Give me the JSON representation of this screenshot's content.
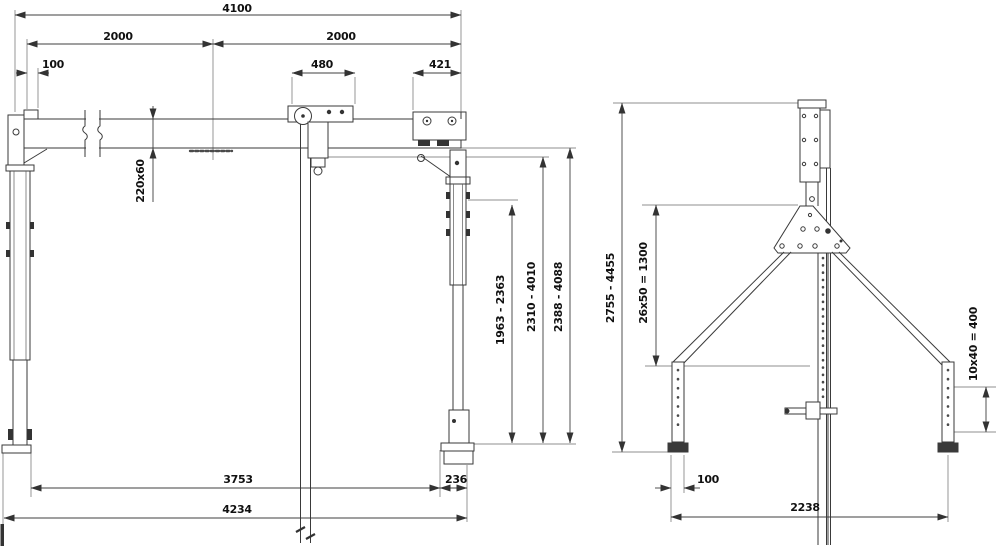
{
  "drawing": {
    "title": "gantry-crane-dimension-drawing",
    "views": {
      "front": {
        "name": "front-view",
        "dims": {
          "overall_rail_length": "4100",
          "span_left": "2000",
          "span_right": "2000",
          "end_offset": "100",
          "trolley_width": "480",
          "bracket_width": "421",
          "rail_section": "220x60",
          "hook_height_range": "1963 - 2363",
          "clear_height_range": "2310 - 4010",
          "overall_height_range": "2388 - 4088",
          "base_inner_span": "3753",
          "foot_length": "236",
          "base_overall_span": "4234"
        }
      },
      "side": {
        "name": "side-view",
        "dims": {
          "overall_height_range": "2755 - 4455",
          "mast_hole_pattern": "26x50 = 1300",
          "leg_hole_pattern": "10x40 = 400",
          "foot_width": "100",
          "base_span": "2238"
        }
      }
    },
    "colors": {
      "line": "#3a3a3a",
      "dimension_line": "#3f3f3f",
      "text": "#111111",
      "background": "#ffffff"
    }
  }
}
